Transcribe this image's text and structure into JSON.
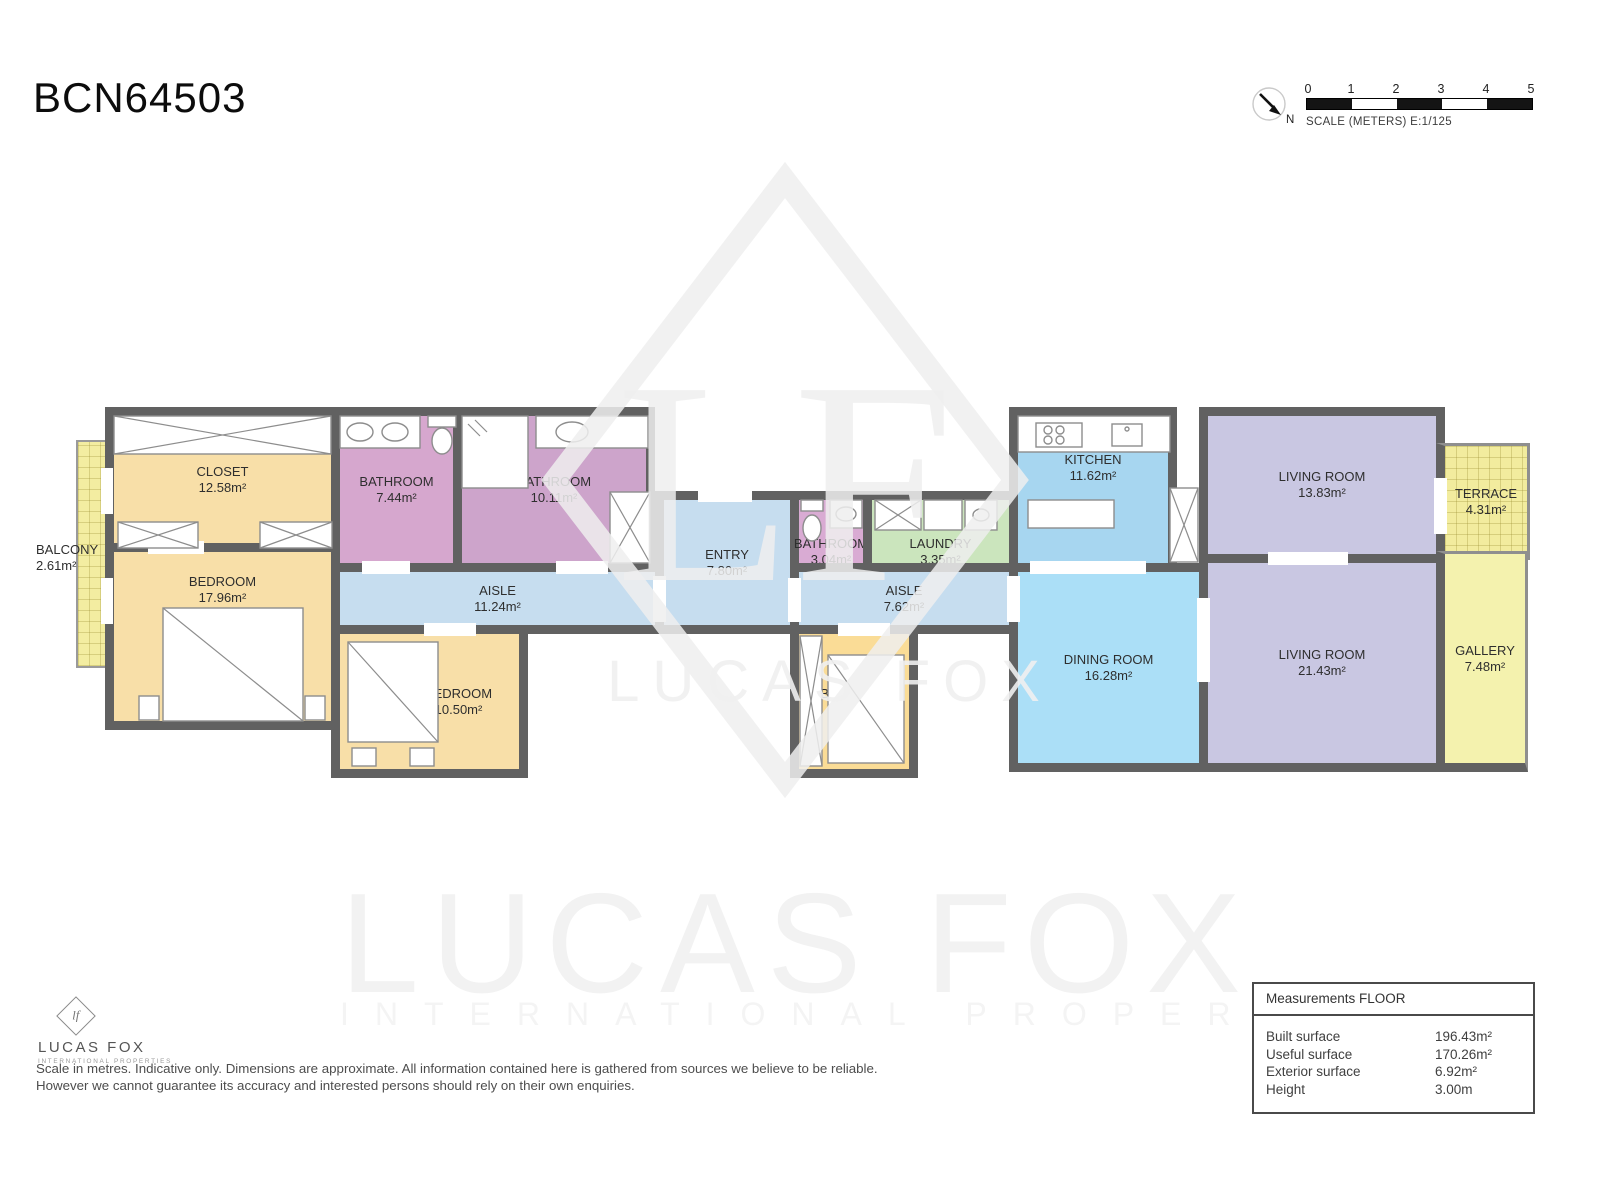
{
  "title": "BCN64503",
  "scale_bar": {
    "ticks": [
      "0",
      "1",
      "2",
      "3",
      "4",
      "5"
    ],
    "label": "SCALE (METERS) E:1/125",
    "north": "N"
  },
  "floorplan": {
    "wall_color": "#616161",
    "rooms": [
      {
        "name": "BALCONY",
        "area": "2.61m²",
        "color": "#f3eda1"
      },
      {
        "name": "CLOSET",
        "area": "12.58m²",
        "color": "#f8dfa8"
      },
      {
        "name": "BEDROOM",
        "area": "17.96m²",
        "color": "#f8dfa8"
      },
      {
        "name": "BATHROOM",
        "area": "7.44m²",
        "color": "#d6a7ce"
      },
      {
        "name": "BATHROOM",
        "area": "10.11m²",
        "color": "#cda4cb"
      },
      {
        "name": "AISLE",
        "area": "11.24m²",
        "color": "#c6ddef"
      },
      {
        "name": "BEDROOM",
        "area": "10.50m²",
        "color": "#f8dfa8"
      },
      {
        "name": "ENTRY",
        "area": "7.80m²",
        "color": "#c6ddef"
      },
      {
        "name": "BATHROOM",
        "area": "3.04m²",
        "color": "#d9abd3"
      },
      {
        "name": "LAUNDRY",
        "area": "3.35m²",
        "color": "#cbe5bd"
      },
      {
        "name": "AISLE",
        "area": "7.62m²",
        "color": "#c6ddef"
      },
      {
        "name": "BEDROOM",
        "area": "7.99m²",
        "color": "#fadc96"
      },
      {
        "name": "KITCHEN",
        "area": "11.62m²",
        "color": "#a7d6f0"
      },
      {
        "name": "DINING ROOM",
        "area": "16.28m²",
        "color": "#abdff7"
      },
      {
        "name": "LIVING ROOM",
        "area": "13.83m²",
        "color": "#c9c7e2"
      },
      {
        "name": "LIVING ROOM",
        "area": "21.43m²",
        "color": "#c9c7e2"
      },
      {
        "name": "TERRACE",
        "area": "4.31m²",
        "color": "#f2ec9e"
      },
      {
        "name": "GALLERY",
        "area": "7.48m²",
        "color": "#f4f2ae"
      }
    ]
  },
  "watermark": {
    "monogram": "LF",
    "name": "LUCAS FOX",
    "tagline": "INTERNATIONAL PROPERTIES"
  },
  "logo": {
    "monogram": "lf",
    "name": "LUCAS FOX",
    "tagline": "INTERNATIONAL PROPERTIES"
  },
  "disclaimer": {
    "line1": "Scale in metres. Indicative only. Dimensions are approximate. All information contained here is gathered from sources we believe to be reliable.",
    "line2": "However we cannot guarantee its accuracy and interested persons should rely on their own enquiries."
  },
  "measurements": {
    "title": "Measurements FLOOR",
    "rows": [
      {
        "label": "Built surface",
        "value": "196.43m²"
      },
      {
        "label": "Useful surface",
        "value": "170.26m²"
      },
      {
        "label": "Exterior surface",
        "value": "6.92m²"
      },
      {
        "label": "Height",
        "value": "3.00m"
      }
    ]
  }
}
